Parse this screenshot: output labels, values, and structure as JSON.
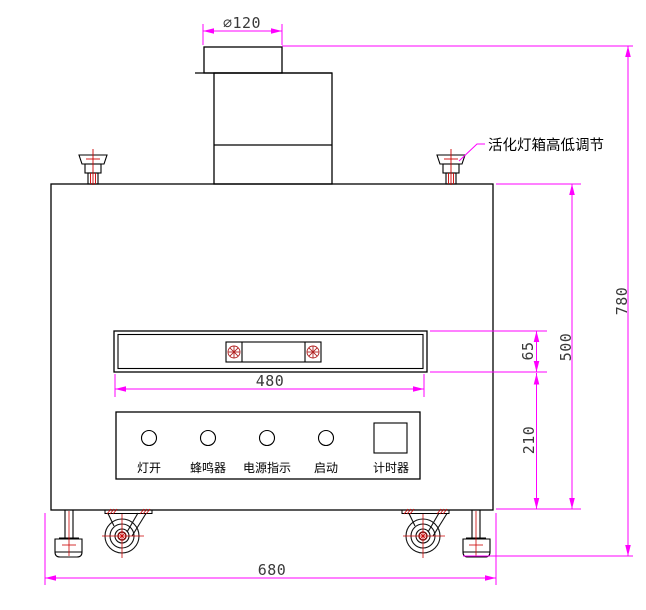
{
  "drawing": {
    "title_hint": "activation-lamp-chamber-front-view",
    "callout": {
      "label": "活化灯箱高低调节"
    },
    "dims": {
      "diameter": "∅120",
      "overall_height": "780",
      "upper_height": "500",
      "window_height": "65",
      "lower_height": "210",
      "window_width": "480",
      "overall_width": "680"
    },
    "panel": {
      "buttons": [
        {
          "label": "灯开"
        },
        {
          "label": "蜂鸣器"
        },
        {
          "label": "电源指示"
        },
        {
          "label": "启动"
        },
        {
          "label": "计时器"
        }
      ]
    },
    "colors": {
      "outline": "#000000",
      "dimension_line": "#FF00FF",
      "centerline": "#DD0000",
      "dim_text": "#3A3A3A"
    }
  }
}
